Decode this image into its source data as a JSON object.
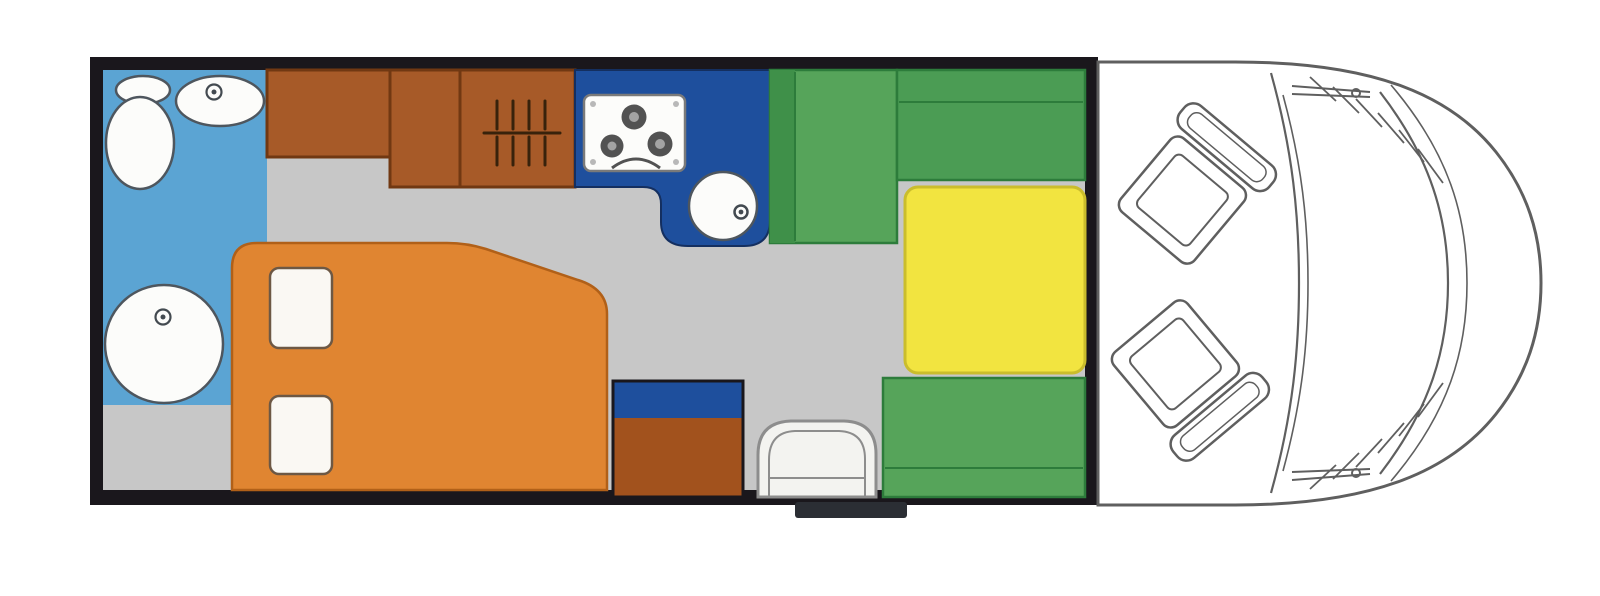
{
  "diagram": {
    "type": "floor-plan",
    "subject": "motorhome",
    "view": "top-down",
    "orientation": "cab-on-right",
    "zones": [
      "bathroom",
      "overhead-cabinets",
      "kitchen",
      "double-bed",
      "dinette",
      "driver-cab"
    ],
    "fixtures": [
      "toilet",
      "washbasin",
      "shower-tray",
      "three-burner-hob",
      "kitchen-sink",
      "bed-pillows",
      "wardrobe-cabinet",
      "entry-seat",
      "bench-seats",
      "dinette-table",
      "swivel-cab-seats",
      "entry-step"
    ]
  },
  "colors": {
    "frame": "#1a171c",
    "floor": "#c7c7c7",
    "bathroom_blue": "#5ba4d3",
    "kitchen_blue": "#1e4f9d",
    "kitchen_outline": "#142f60",
    "cabinet_brown": "#a75a28",
    "cabinet_outline": "#713812",
    "cabinet_brown_dark": "#a2521d",
    "bed_orange": "#e08531",
    "bed_outline": "#b16018",
    "pillow_white": "#faf8f3",
    "pillow_outline": "#6d5844",
    "bench_green": "#56a45a",
    "bench_green_mid": "#4b9c54",
    "bench_green_dark": "#3f9049",
    "green_outline": "#2d7c3b",
    "table_yellow": "#f2e440",
    "table_outline": "#cabd2c",
    "fixture_white": "#fcfcfa",
    "fixture_outline": "#4e565e",
    "drain_dark": "#434a50",
    "stove_outline": "#7a7a7a",
    "burner": "#525252",
    "burner_center": "#a3a3a3",
    "screw": "#b8b8b8",
    "grill": "#38220b",
    "seat_gray": "#f3f3f0",
    "seat_outline": "#8d8d8d",
    "cab_line": "#5f5f5f",
    "cab_white": "#ffffff",
    "step": "#2b2e34"
  }
}
